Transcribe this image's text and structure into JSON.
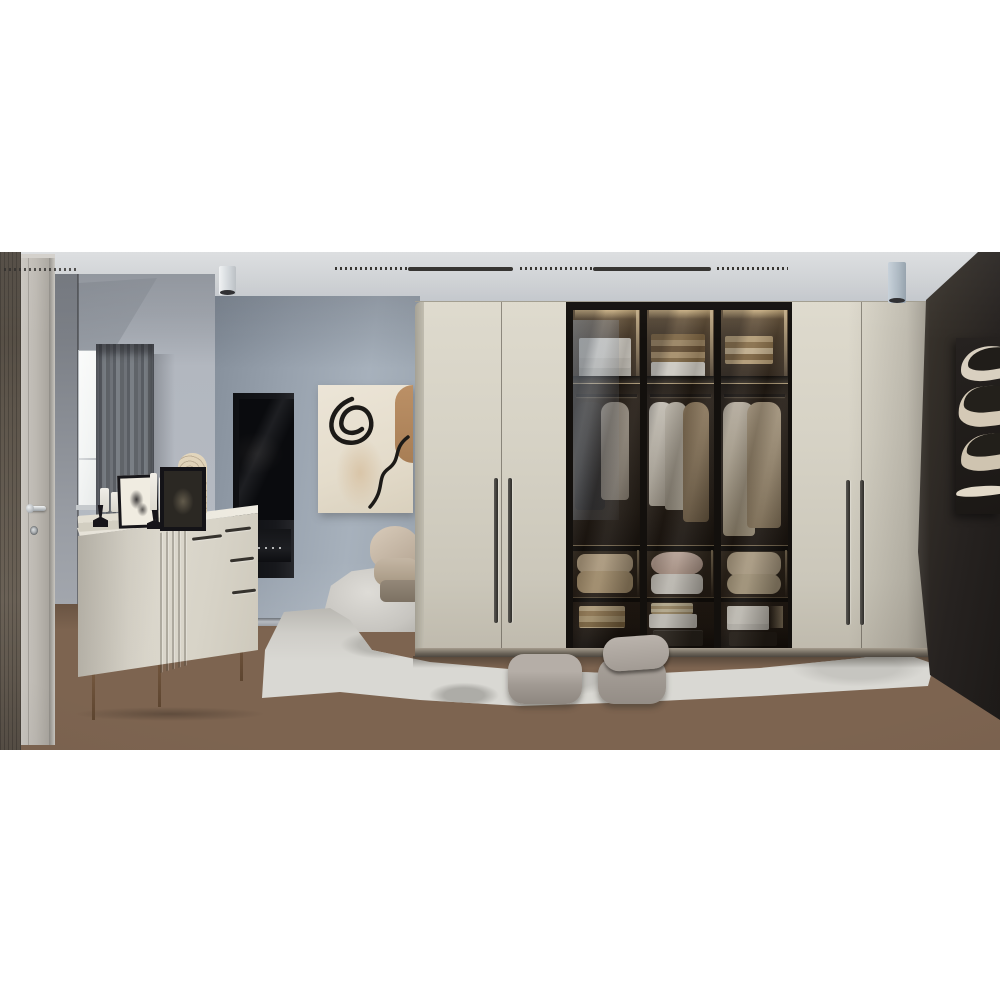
{
  "meta": {
    "type": "interior-photograph",
    "subject": "Modern bedroom with floor-to-ceiling wardrobe",
    "presentation": "photo centered on white canvas, no visible text"
  },
  "palette": {
    "canvas_background": "#ffffff",
    "ceiling": "#cdd0d3",
    "wall_blue_grey": "#9aa4af",
    "wall_dark_brown": "#262220",
    "wardrobe_cream": "#d5d1c4",
    "glass_interior_dark": "#241c14",
    "interior_led_glow": "#f0d7a5",
    "floor_wood": "#7d6450",
    "rug_grey_white": "#d9d8d3",
    "entry_door_grey": "#bcb8b1",
    "hall_wood_panel": "#5d554b",
    "pouf_taupe": "#a29b94",
    "artwork_canvas_cream": "#e9e2d4",
    "artwork_tan": "#b3875d",
    "artwork_dark_canvas": "#1f1c18",
    "curtain_grey": "#636770",
    "handle_dark": "#2e2c29",
    "chrome": "#c9ced2"
  },
  "scene": {
    "objects": [
      {
        "id": 0,
        "label": "Dark wood wall panel in hallway"
      },
      {
        "id": 1,
        "label": "Light grey entry door with chrome lever handle and keyhole"
      },
      {
        "id": 2,
        "label": "Window with white sheer and grey drapes"
      },
      {
        "id": 3,
        "label": "Recessed TV niche with television and AV receiver"
      },
      {
        "id": 4,
        "label": "Abstract line-art painting on blue-grey wall"
      },
      {
        "id": 5,
        "label": "Cream fluted sideboard with frames, candles and vase decor"
      },
      {
        "id": 6,
        "label": "Beige lounge chair on small rug"
      },
      {
        "id": 7,
        "label": "Cream wardrobe with hinged doors and dark vertical handles"
      },
      {
        "id": 8,
        "label": "Smoked-glass wardrobe doors showing lit shelves, hanging clothes, pillows and boxes"
      },
      {
        "id": 9,
        "label": "Dark abstract canvas on brown feature wall"
      },
      {
        "id": 10,
        "label": "Shaggy grey-white area rug"
      },
      {
        "id": 11,
        "label": "Grey fabric floor poufs"
      },
      {
        "id": 12,
        "label": "Linear dotted ceiling track light"
      },
      {
        "id": 13,
        "label": "Cylindrical surface-mounted downlights"
      },
      {
        "id": 14,
        "label": "Herringbone wood floor"
      }
    ]
  }
}
